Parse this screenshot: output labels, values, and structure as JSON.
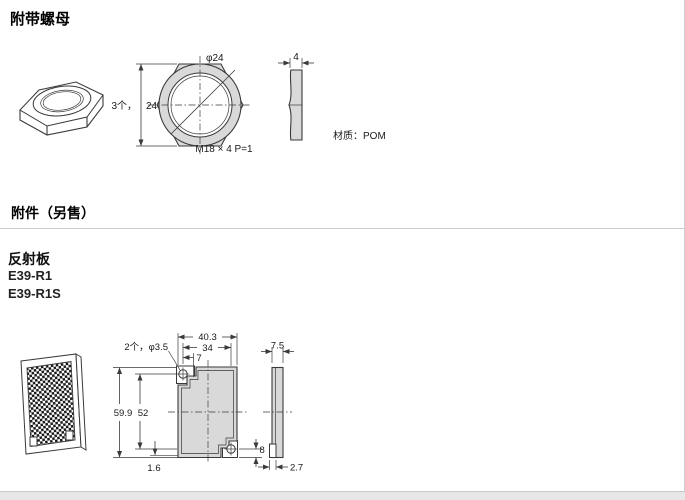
{
  "titles": {
    "nut_section": "附带螺母",
    "accessory_section": "附件（另售）",
    "reflector_heading": "反射板",
    "model_1": "E39-R1",
    "model_2": "E39-R1S"
  },
  "nut_drawing": {
    "dia_label": "φ24",
    "qty_label": "3个，",
    "across_flats": "24",
    "thread_label": "M18 × 4  P=1",
    "thickness": "4",
    "material_label": "材质：POM"
  },
  "reflector_drawing": {
    "overall_width": "40.3",
    "hole_pitch_h": "34",
    "hole_edge_offset": "7",
    "holes_label": "2个，φ3.5",
    "overall_height": "59.9",
    "hole_pitch_v": "52",
    "lip_thickness": "1.6",
    "hole_bottom_offset": "8",
    "depth": "7.5",
    "tab_thickness": "2.7"
  }
}
